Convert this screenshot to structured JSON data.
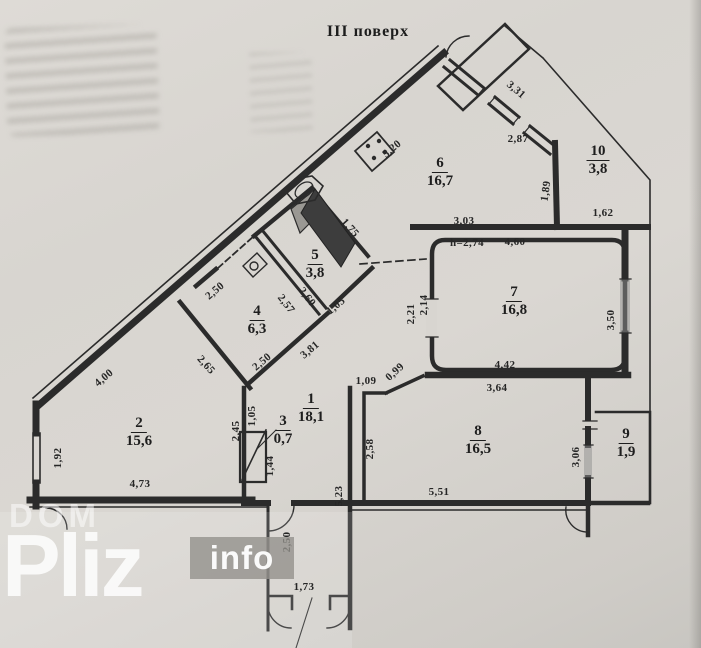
{
  "title": "III поверх",
  "colors": {
    "paper": "#d8d5d0",
    "ink": "#2b2b2b",
    "vent_shaft": "#3d3d3d",
    "window_fill": "#8f8f8f",
    "watermark_box": "rgba(147,145,140,0.8)"
  },
  "watermark": {
    "line1": "DOM",
    "line2": "Pliz",
    "line3": "info"
  },
  "icons": {
    "stove": "stove-4-burners",
    "sink": "kitchen-sink",
    "vent": "ventilation-shaft",
    "doors": "door-swing-arcs",
    "windows": "window-hatch-marks"
  },
  "rooms": [
    {
      "number": "1",
      "area": "18,1",
      "x": 311,
      "y": 408
    },
    {
      "number": "2",
      "area": "15,6",
      "x": 139,
      "y": 432
    },
    {
      "number": "3",
      "area": "0,7",
      "x": 283,
      "y": 430
    },
    {
      "number": "4",
      "area": "6,3",
      "x": 257,
      "y": 320
    },
    {
      "number": "5",
      "area": "3,8",
      "x": 315,
      "y": 264
    },
    {
      "number": "6",
      "area": "16,7",
      "x": 440,
      "y": 172
    },
    {
      "number": "7",
      "area": "16,8",
      "x": 514,
      "y": 301
    },
    {
      "number": "8",
      "area": "16,5",
      "x": 478,
      "y": 440
    },
    {
      "number": "9",
      "area": "1,9",
      "x": 626,
      "y": 443
    },
    {
      "number": "10",
      "area": "3,8",
      "x": 598,
      "y": 160
    }
  ],
  "dimensions": [
    {
      "text": "5,20",
      "x": 392,
      "y": 149,
      "rot": -40
    },
    {
      "text": "3,31",
      "x": 516,
      "y": 90,
      "rot": 40
    },
    {
      "text": "2,87",
      "x": 518,
      "y": 139,
      "rot": 0
    },
    {
      "text": "1,89",
      "x": 546,
      "y": 191,
      "rot": -82
    },
    {
      "text": "1,62",
      "x": 603,
      "y": 213,
      "rot": 0
    },
    {
      "text": "3,03",
      "x": 464,
      "y": 221,
      "rot": 0
    },
    {
      "text": "h=2,74",
      "x": 467,
      "y": 243,
      "rot": 0
    },
    {
      "text": "4,60",
      "x": 515,
      "y": 242,
      "rot": 0
    },
    {
      "text": "2,21",
      "x": 411,
      "y": 314,
      "rot": -90
    },
    {
      "text": "2,14",
      "x": 424,
      "y": 305,
      "rot": -90
    },
    {
      "text": "3,50",
      "x": 611,
      "y": 320,
      "rot": -90
    },
    {
      "text": "4,42",
      "x": 505,
      "y": 365,
      "rot": 0
    },
    {
      "text": "3,64",
      "x": 497,
      "y": 388,
      "rot": 0
    },
    {
      "text": "1,75",
      "x": 350,
      "y": 228,
      "rot": 48
    },
    {
      "text": "2,60",
      "x": 307,
      "y": 297,
      "rot": 52
    },
    {
      "text": "2,57",
      "x": 286,
      "y": 304,
      "rot": 52
    },
    {
      "text": "1,05",
      "x": 336,
      "y": 306,
      "rot": -40
    },
    {
      "text": "3,81",
      "x": 310,
      "y": 350,
      "rot": -40
    },
    {
      "text": "2,50",
      "x": 262,
      "y": 362,
      "rot": -40
    },
    {
      "text": "2,50",
      "x": 215,
      "y": 291,
      "rot": -40
    },
    {
      "text": "2,65",
      "x": 206,
      "y": 365,
      "rot": 48
    },
    {
      "text": "4,00",
      "x": 104,
      "y": 378,
      "rot": -40
    },
    {
      "text": "1,92",
      "x": 58,
      "y": 458,
      "rot": -90
    },
    {
      "text": "4,73",
      "x": 140,
      "y": 484,
      "rot": 0
    },
    {
      "text": "2,45",
      "x": 236,
      "y": 431,
      "rot": -90
    },
    {
      "text": "1,05",
      "x": 252,
      "y": 416,
      "rot": -90
    },
    {
      "text": "1,44",
      "x": 270,
      "y": 466,
      "rot": -90
    },
    {
      "text": "1,09",
      "x": 366,
      "y": 381,
      "rot": 0
    },
    {
      "text": "0,99",
      "x": 395,
      "y": 372,
      "rot": -42
    },
    {
      "text": "2,58",
      "x": 370,
      "y": 449,
      "rot": -90
    },
    {
      "text": "5,23",
      "x": 339,
      "y": 496,
      "rot": -90
    },
    {
      "text": "5,51",
      "x": 439,
      "y": 492,
      "rot": 0
    },
    {
      "text": "3,06",
      "x": 576,
      "y": 457,
      "rot": -90
    },
    {
      "text": "2,50",
      "x": 287,
      "y": 542,
      "rot": -90
    },
    {
      "text": "1,73",
      "x": 304,
      "y": 587,
      "rot": 0
    }
  ]
}
